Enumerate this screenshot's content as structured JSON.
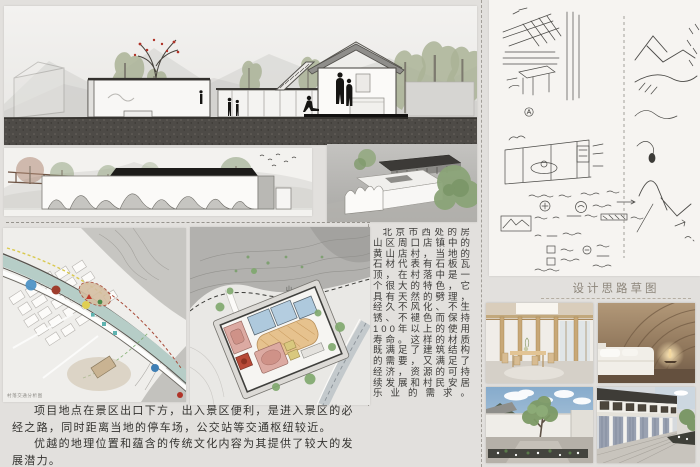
{
  "board": {
    "background": "#e2e0dd",
    "colors": {
      "accent_red": "#b03328",
      "river": "#b6cdc7",
      "sky": "#8fb2d2",
      "marker_blue": "#4e93c6",
      "marker_dark_red": "#9e3c2c",
      "marker_yellow": "#e0cf52",
      "plan_room_blue": "#aec9dd",
      "plan_court_orange": "#e6c28e",
      "plan_room_pink": "#dcaaa2"
    }
  },
  "stone_text": {
    "body": "北京市西处的房山区周口店镇中的黄山店村，当地的石材代表有石板瓦顶，在村落中是一个很大的特色，它具有天然的劈理，经久不风化、不生锈、不褪色而保持100年以上的使用寿命。这样的材质既满足了建筑结构的需要，又满足了经济，资源的可持续发展和村民安居乐业的需求。"
  },
  "location_text": {
    "para1": "项目地点在景区出口下方，出入景区便利，是进入景区的必经之路，同时距离当地的停车场，公交站等交通枢纽较近。",
    "para2": "优越的地理位置和蕴含的传统文化内容为其提供了较大的发展潜力。"
  },
  "sketch_section": {
    "caption": "设计思路草图"
  },
  "site_map": {
    "caption": "村落交通分析图"
  },
  "master_plan": {
    "label_mountain": "山 体",
    "label_slope": "土坡"
  }
}
